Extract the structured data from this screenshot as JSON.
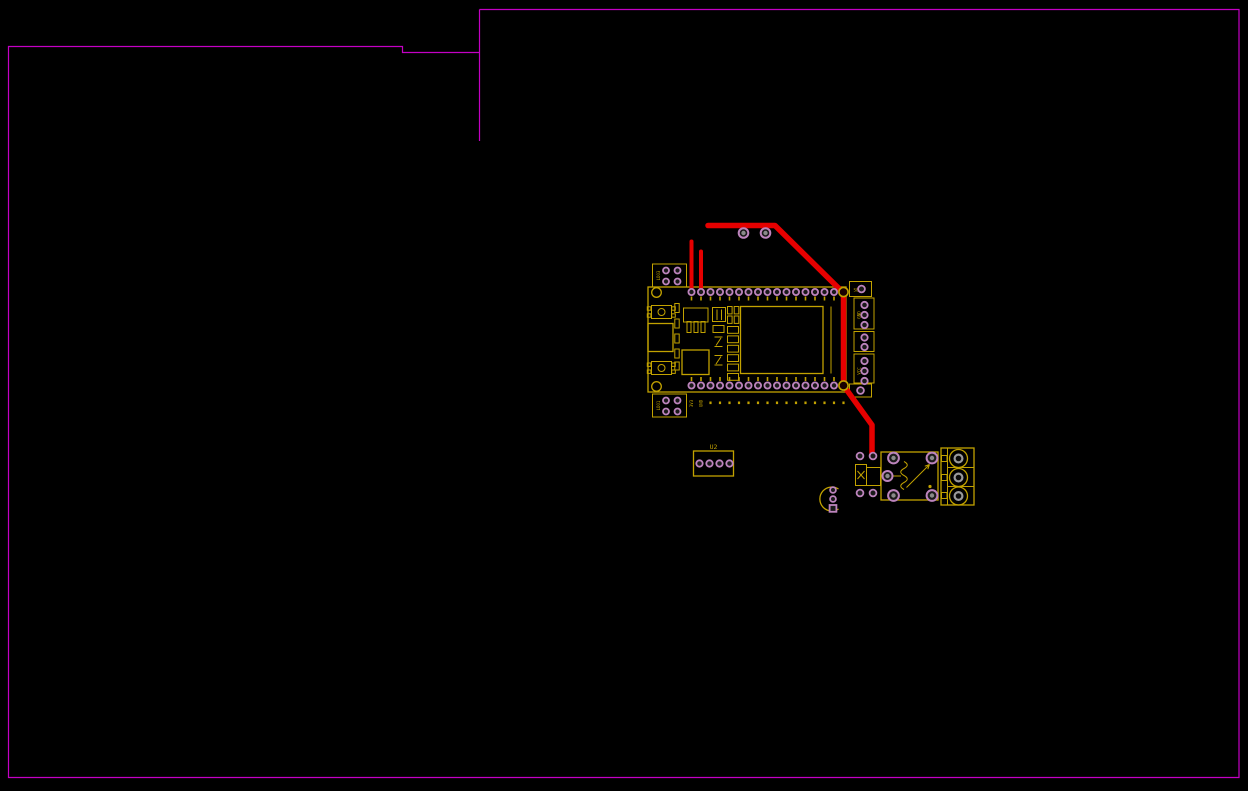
{
  "app": {
    "type": "pcb-layout-editor-canvas",
    "description": "PCB layout view: ESP32 relay board with board outline, footprints and red routed traces"
  },
  "canvas": {
    "width": 1248,
    "height": 791,
    "background": "#000000"
  },
  "colors": {
    "board_outline": "#c400c4",
    "silkscreen": "#c2a200",
    "pad_ring": "#bd84bd",
    "pad_hole": "#1a1a1a",
    "via_center": "#8a8a8a",
    "trace": "#e60000",
    "terminal_inner": "#9a9a9a"
  },
  "labels": {
    "u2": "U2",
    "right_block_top": "S0",
    "right_block_gnd": "GND",
    "right_block_vcc": "VCC",
    "left_block_top": "LDO3",
    "left_block_bottom": "LDO1",
    "bottom_pin_label_1": "3V3",
    "bottom_pin_label_2": "GND"
  },
  "structure": {
    "esp32_board": {
      "top_pins": 17,
      "bottom_pins": 17,
      "mounting_holes": 2
    },
    "u2_connector": {
      "pins": 4
    },
    "right_connector_blocks": {
      "pad_counts": [
        1,
        3,
        2,
        3,
        1
      ]
    },
    "left_jumper_blocks": {
      "pads_each": 4
    },
    "relay": {
      "pads": 5
    },
    "terminal_block": {
      "positions": 3
    },
    "transistor": {
      "pins": 3
    },
    "diode": {
      "pads": 4
    },
    "vias_top": 2,
    "red_trace_segments": 3
  }
}
